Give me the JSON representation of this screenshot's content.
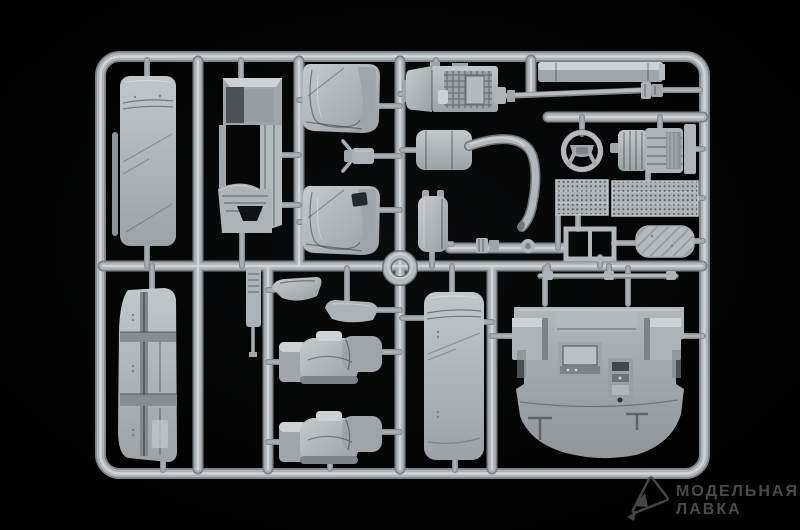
{
  "scene": {
    "subject": "gray injection-molded model kit sprue photographed on black background",
    "parts": [
      "sleeper-bunk-mattress-upper-left",
      "thin-rod",
      "cab-rear-wall-panel",
      "seat-backrest-shell-1",
      "seat-backrest-shell-2",
      "small-mounting-bracket",
      "engine-block-with-lattice",
      "drive-shaft",
      "roof-fairing-bar",
      "steering-wheel",
      "gearbox-transmission",
      "mesh-grille-panel-1",
      "mesh-grille-panel-2",
      "muffler-with-exhaust-pipe",
      "tank",
      "pipe-coupler",
      "disc-cap",
      "double-window-frame",
      "oval-tread-plate",
      "long-rod",
      "center-ring",
      "part-number-tag",
      "armrest-1",
      "armrest-console",
      "seat-assembly-1",
      "seat-assembly-2",
      "folded-bunk-panel-lower-left",
      "sleeper-bunk-mattress-lower-center",
      "cab-floor-panel"
    ]
  },
  "colors": {
    "background": "#000000",
    "plastic_base": "#aeb3b7",
    "plastic_light": "#ced2d5",
    "plastic_shadow": "#7e8387",
    "plastic_recess": "#4d5155",
    "watermark": "#515151"
  },
  "watermark": {
    "logo_icon": "paper-plane-logo",
    "line1": "МОДЕЛЬНАЯ",
    "line2": "ЛАВКА"
  }
}
